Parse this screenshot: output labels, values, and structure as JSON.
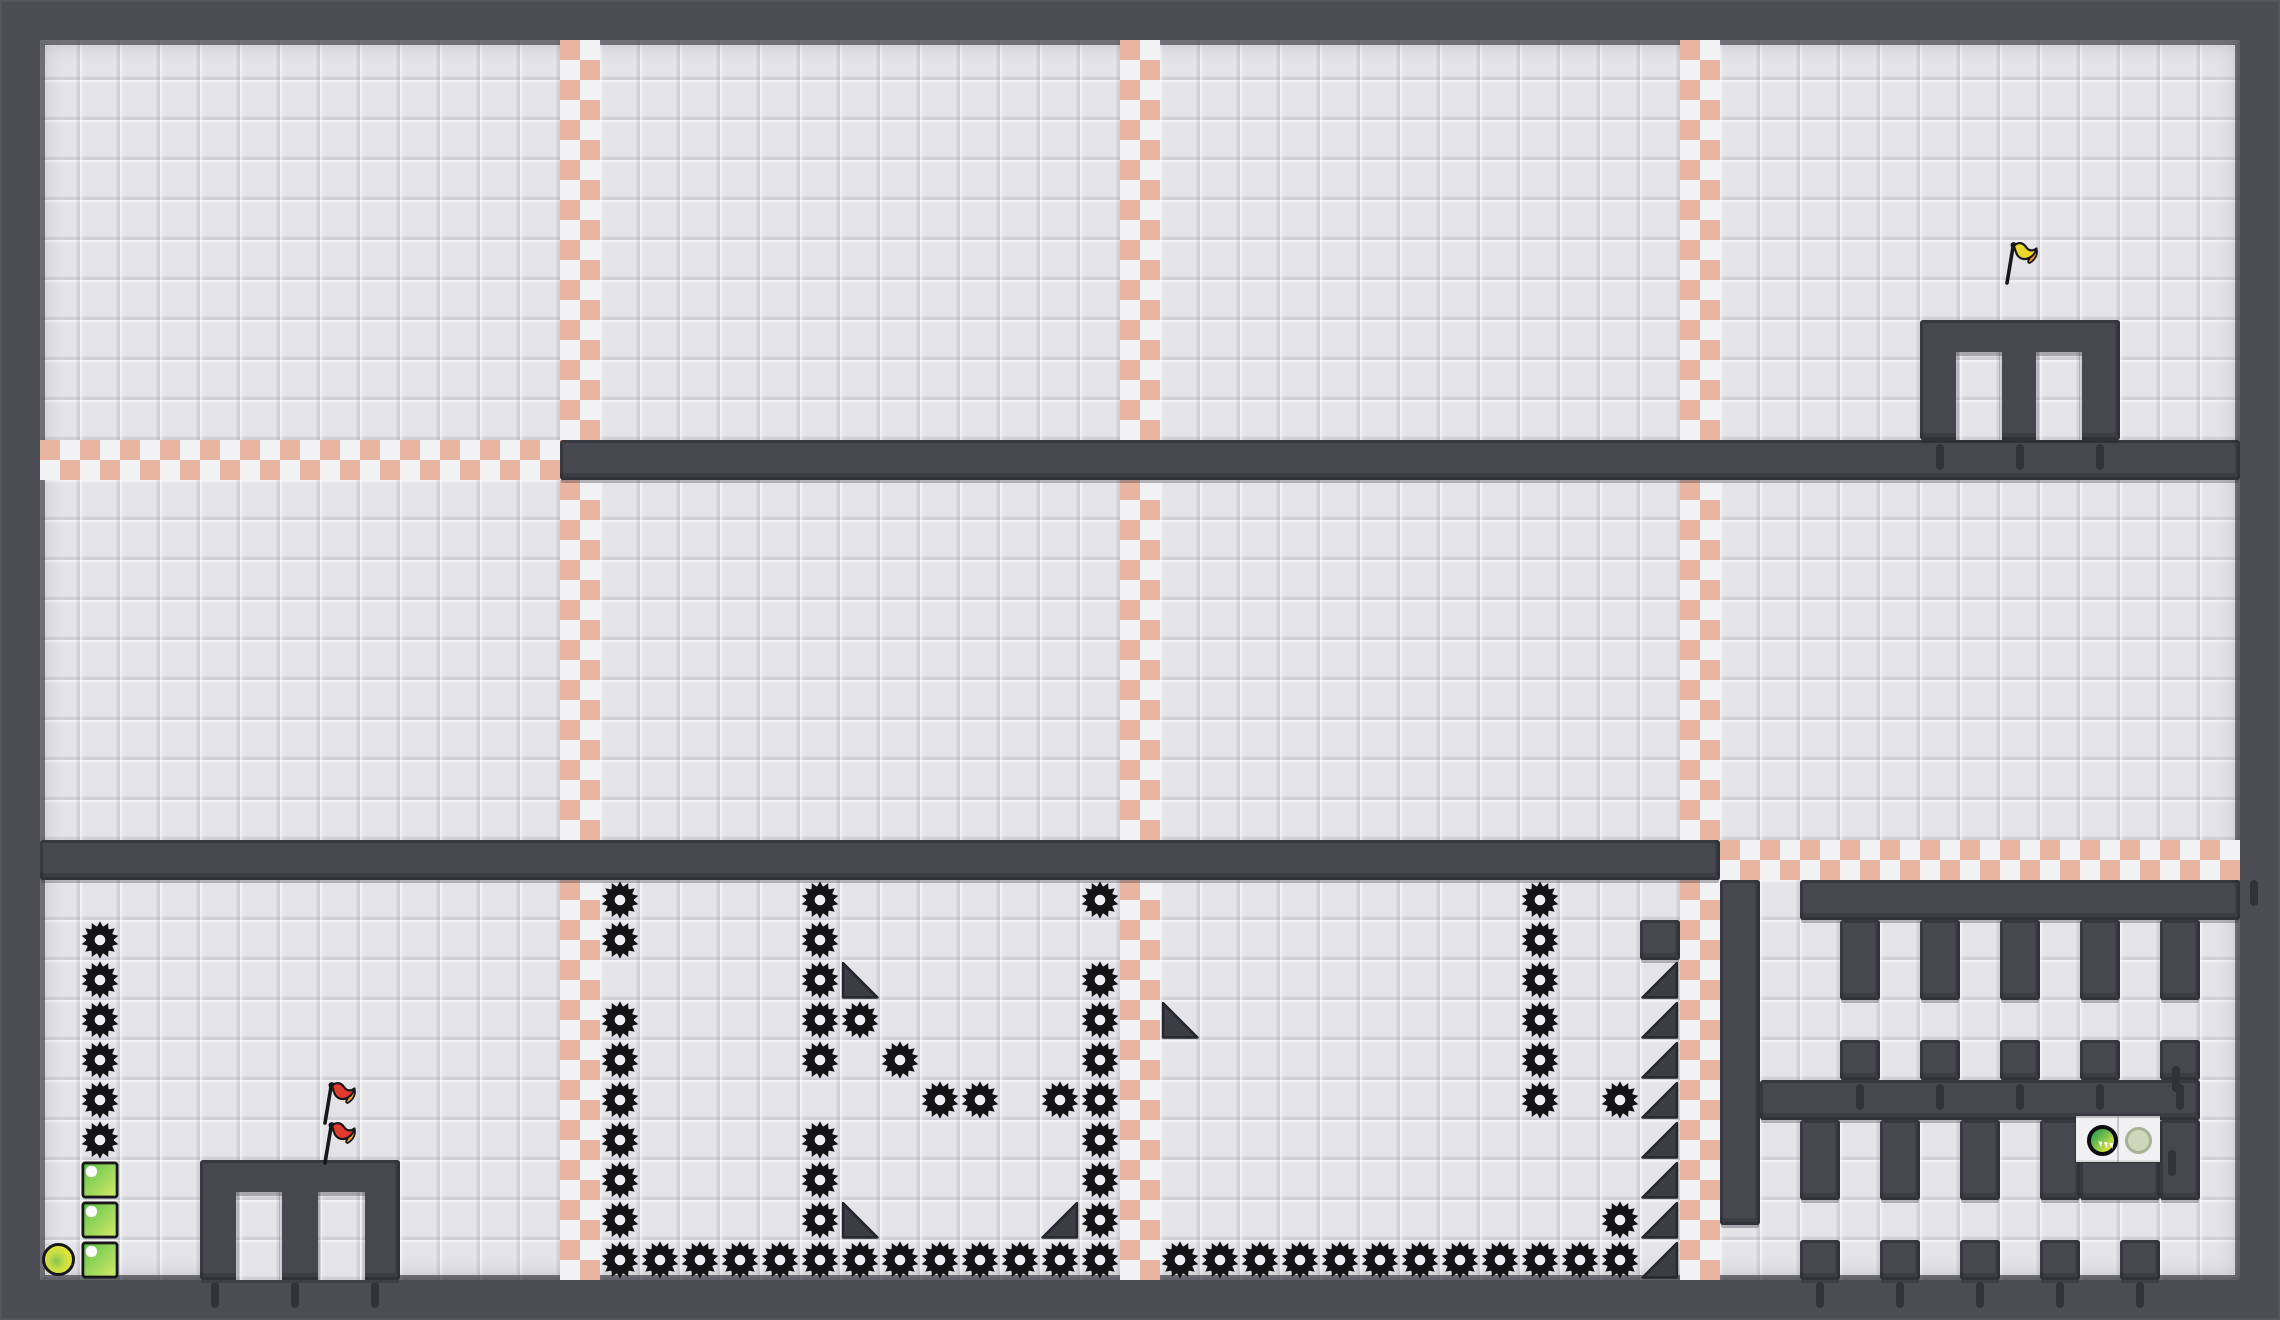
{
  "app": {
    "type": "2d-platformer-level-view",
    "viewport": {
      "width": 2280,
      "height": 1320
    },
    "visible_text": []
  },
  "colors": {
    "frame": "#4c4c54",
    "wall": "#47474f",
    "tile": "#e4e3e8",
    "checker_peach": "#e8b5a1",
    "checker_white": "#f2f1f4",
    "saw": "#141417",
    "saw_hole": "#eff0f2",
    "spike": "#3c3c45",
    "spike_edge": "#26262d",
    "outline": "#17171a",
    "tick": "#32323a",
    "flag_red": "#e03c2e",
    "flag_yellow": "#e8d829",
    "flag_tip": "#f09a2c",
    "block_g1": "#5fbf4c",
    "block_g2": "#d3ec69",
    "ball_green": "#85c44e",
    "ball_yellow": "#e6e331",
    "panel": "#f1f0f3",
    "btn_pale": "#cdd8bb"
  },
  "level": {
    "tile_size": 40,
    "border": 40,
    "grid_cols": 55,
    "grid_rows": 31,
    "checker_vertical": [
      [
        560,
        40,
        1240
      ],
      [
        1120,
        40,
        1240
      ],
      [
        1680,
        40,
        1240
      ]
    ],
    "checker_horizontal": [
      [
        40,
        440,
        520
      ],
      [
        1720,
        840,
        520
      ]
    ],
    "walls": [
      [
        560,
        440,
        1680,
        40
      ],
      [
        40,
        840,
        1680,
        40
      ],
      [
        1920,
        320,
        200,
        120
      ],
      [
        200,
        1160,
        200,
        120
      ],
      [
        1720,
        880,
        40,
        345
      ],
      [
        1800,
        880,
        440,
        40
      ],
      [
        1840,
        920,
        40,
        80
      ],
      [
        1920,
        920,
        40,
        80
      ],
      [
        2000,
        920,
        40,
        80
      ],
      [
        2080,
        920,
        40,
        80
      ],
      [
        2160,
        920,
        40,
        80
      ],
      [
        1840,
        1040,
        40,
        40
      ],
      [
        1920,
        1040,
        40,
        40
      ],
      [
        2000,
        1040,
        40,
        40
      ],
      [
        2080,
        1040,
        40,
        40
      ],
      [
        2160,
        1040,
        40,
        40
      ],
      [
        1760,
        1080,
        440,
        40
      ],
      [
        1800,
        1120,
        40,
        80
      ],
      [
        1880,
        1120,
        40,
        80
      ],
      [
        1960,
        1120,
        40,
        80
      ],
      [
        2040,
        1120,
        40,
        80
      ],
      [
        2160,
        1120,
        40,
        80
      ],
      [
        2080,
        1160,
        80,
        40
      ],
      [
        1800,
        1240,
        40,
        40
      ],
      [
        1880,
        1240,
        40,
        40
      ],
      [
        1960,
        1240,
        40,
        40
      ],
      [
        2040,
        1240,
        40,
        40
      ],
      [
        2120,
        1240,
        40,
        40
      ],
      [
        1640,
        920,
        40,
        40
      ]
    ],
    "doors": [
      [
        1956,
        352,
        46,
        88
      ],
      [
        2036,
        352,
        46,
        88
      ],
      [
        236,
        1192,
        46,
        88
      ],
      [
        318,
        1192,
        47,
        88
      ]
    ],
    "wall_ticks": [
      [
        1936,
        444
      ],
      [
        2016,
        444
      ],
      [
        2096,
        444
      ],
      [
        211,
        1282
      ],
      [
        291,
        1282
      ],
      [
        371,
        1282
      ],
      [
        1856,
        1084
      ],
      [
        1936,
        1084
      ],
      [
        2016,
        1084
      ],
      [
        2096,
        1084
      ],
      [
        2176,
        1084
      ],
      [
        1816,
        1282
      ],
      [
        1896,
        1282
      ],
      [
        1976,
        1282
      ],
      [
        2056,
        1282
      ],
      [
        2136,
        1282
      ],
      [
        2168,
        1150
      ],
      [
        2172,
        1066
      ],
      [
        2250,
        880
      ]
    ],
    "saws": [
      [
        1,
        22
      ],
      [
        1,
        23
      ],
      [
        1,
        24
      ],
      [
        1,
        25
      ],
      [
        1,
        26
      ],
      [
        1,
        27
      ],
      [
        14,
        21
      ],
      [
        14,
        22
      ],
      [
        14,
        24
      ],
      [
        14,
        25
      ],
      [
        14,
        26
      ],
      [
        14,
        27
      ],
      [
        14,
        28
      ],
      [
        14,
        29
      ],
      [
        19,
        21
      ],
      [
        19,
        22
      ],
      [
        19,
        23
      ],
      [
        19,
        24
      ],
      [
        19,
        25
      ],
      [
        19,
        27
      ],
      [
        19,
        28
      ],
      [
        19,
        29
      ],
      [
        26,
        21
      ],
      [
        26,
        23
      ],
      [
        26,
        24
      ],
      [
        26,
        25
      ],
      [
        26,
        26
      ],
      [
        26,
        27
      ],
      [
        26,
        28
      ],
      [
        26,
        29
      ],
      [
        20,
        24
      ],
      [
        21,
        25
      ],
      [
        22,
        26
      ],
      [
        23,
        26
      ],
      [
        25,
        26
      ],
      [
        14,
        30
      ],
      [
        15,
        30
      ],
      [
        16,
        30
      ],
      [
        17,
        30
      ],
      [
        18,
        30
      ],
      [
        19,
        30
      ],
      [
        20,
        30
      ],
      [
        21,
        30
      ],
      [
        22,
        30
      ],
      [
        23,
        30
      ],
      [
        24,
        30
      ],
      [
        25,
        30
      ],
      [
        26,
        30
      ],
      [
        37,
        21
      ],
      [
        37,
        22
      ],
      [
        37,
        23
      ],
      [
        37,
        24
      ],
      [
        37,
        25
      ],
      [
        37,
        26
      ],
      [
        39,
        26
      ],
      [
        39,
        29
      ],
      [
        28,
        30
      ],
      [
        29,
        30
      ],
      [
        30,
        30
      ],
      [
        31,
        30
      ],
      [
        32,
        30
      ],
      [
        33,
        30
      ],
      [
        34,
        30
      ],
      [
        35,
        30
      ],
      [
        36,
        30
      ],
      [
        37,
        30
      ],
      [
        38,
        30
      ],
      [
        39,
        30
      ]
    ],
    "spikes": [
      [
        20,
        23,
        "bl"
      ],
      [
        28,
        24,
        "bl"
      ],
      [
        20,
        29,
        "bl"
      ],
      [
        25,
        29,
        "br"
      ],
      [
        40,
        23,
        "br"
      ],
      [
        40,
        24,
        "br"
      ],
      [
        40,
        25,
        "br"
      ],
      [
        40,
        26,
        "br"
      ],
      [
        40,
        27,
        "br"
      ],
      [
        40,
        28,
        "br"
      ],
      [
        40,
        29,
        "br"
      ],
      [
        40,
        30,
        "br"
      ]
    ],
    "crates": [
      [
        1,
        28
      ],
      [
        1,
        29
      ],
      [
        1,
        30
      ]
    ],
    "flags": [
      {
        "x": 314,
        "y": 1078,
        "color": "red"
      },
      {
        "x": 314,
        "y": 1118,
        "color": "red"
      },
      {
        "x": 1996,
        "y": 238,
        "color": "yellow"
      }
    ],
    "player": {
      "x": 42,
      "y": 1243,
      "d": 33
    },
    "button_panel": {
      "x": 2076,
      "y": 1116,
      "w": 84,
      "h": 46,
      "buttons": [
        {
          "cx": 2102,
          "cy": 1140,
          "d": 31,
          "state": "active"
        },
        {
          "cx": 2138,
          "cy": 1140,
          "d": 27,
          "state": "inactive"
        }
      ]
    }
  }
}
